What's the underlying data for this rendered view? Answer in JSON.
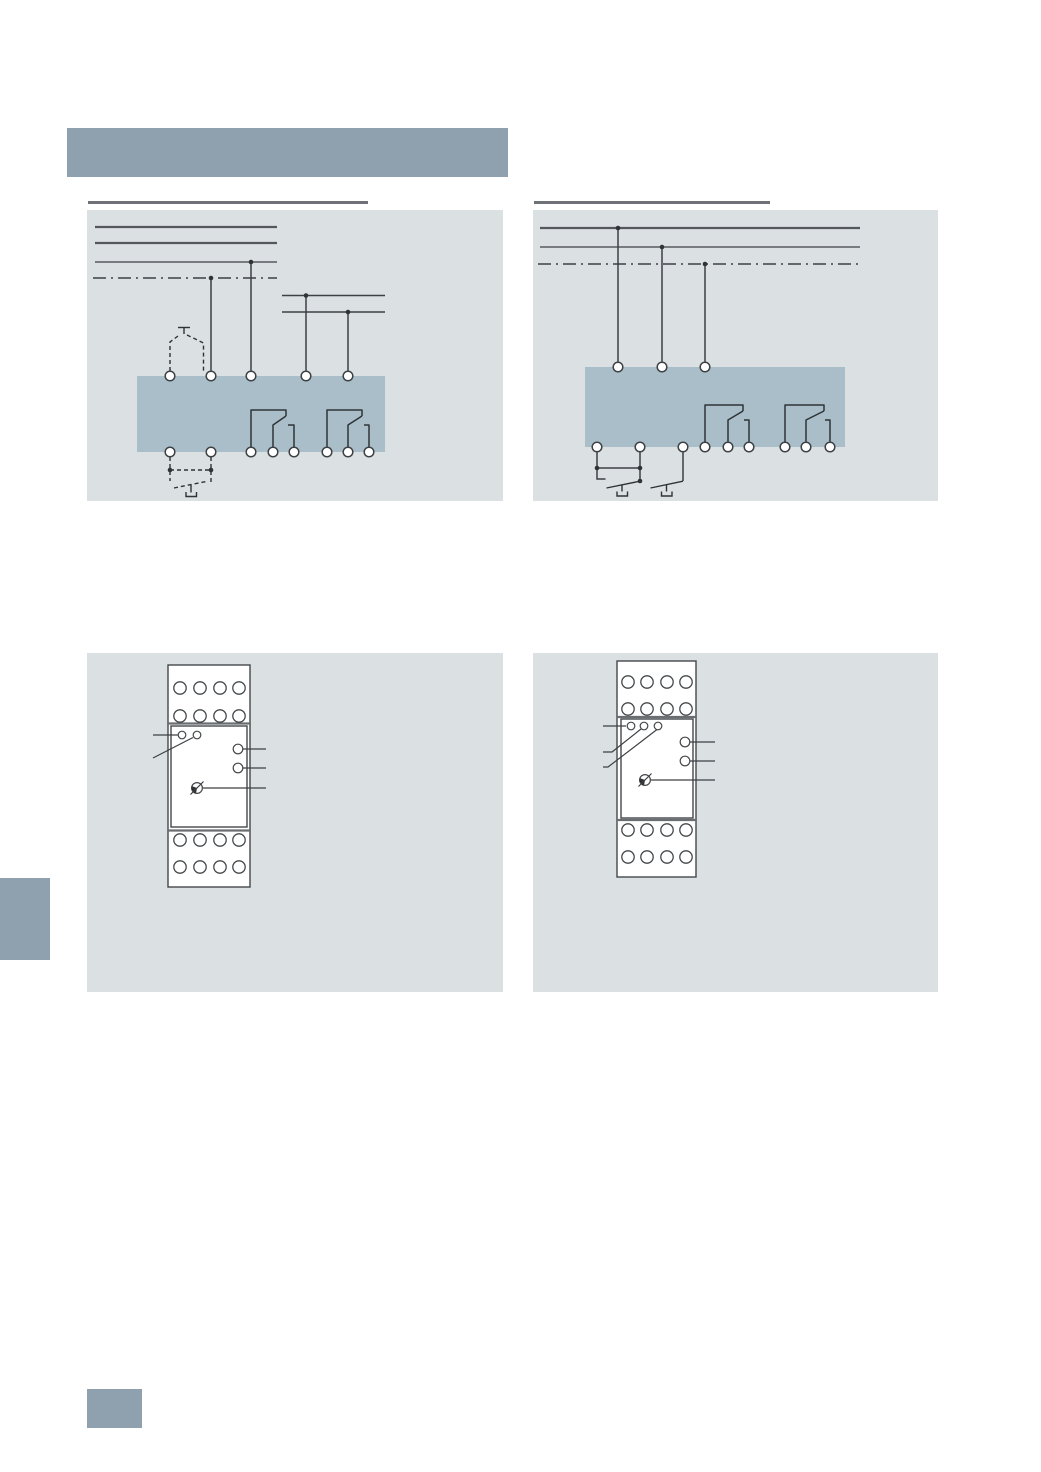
{
  "page": {
    "width": 1041,
    "height": 1472,
    "kind": "technical-catalog-page",
    "visible_text": ""
  },
  "colors": {
    "page_bg": "#ffffff",
    "accent": "#8fa1ae",
    "panel_bg": "#dbe0e3",
    "device_fill": "#a9bec9",
    "line": "#3d4144",
    "rail": "#54585c",
    "ink": "#2f3336",
    "rule": "#6e7276",
    "outline": "#44484b",
    "divider": "#6a6e72",
    "white": "#ffffff"
  },
  "header": {
    "caption_text": ""
  },
  "figures": [
    {
      "name": "wiring-diagram-left",
      "caption_text": "",
      "type": "schematic",
      "supply_rails_solid": 3,
      "supply_rails_dashdot": 1,
      "aux_rails": 2,
      "top_terminals": 5,
      "bottom_terminals": 8,
      "changeover_contacts": 2,
      "external_pushbuttons": 2,
      "pushbutton_wiring": "dashed"
    },
    {
      "name": "wiring-diagram-right",
      "caption_text": "",
      "type": "schematic",
      "supply_rails_solid": 2,
      "supply_rails_dashdot": 1,
      "aux_rails": 0,
      "top_terminals": 3,
      "bottom_terminals": 9,
      "changeover_contacts": 2,
      "external_pushbuttons": 2,
      "pushbutton_wiring": "solid"
    },
    {
      "name": "device-front-view-left",
      "caption_text": "",
      "type": "front-view",
      "terminal_rows_top": 2,
      "terminal_rows_bottom": 2,
      "terminals_per_row": 4,
      "indicator_leds": 2,
      "adjuster_dials": 2,
      "rotary_selector": 1,
      "callout_lines_left": 2,
      "callout_lines_right": 3
    },
    {
      "name": "device-front-view-right",
      "caption_text": "",
      "type": "front-view",
      "terminal_rows_top": 2,
      "terminal_rows_bottom": 2,
      "terminals_per_row": 4,
      "indicator_leds": 3,
      "adjuster_dials": 2,
      "rotary_selector": 1,
      "callout_lines_left": 3,
      "callout_lines_right": 3
    }
  ],
  "margin_marks": {
    "section_tab": "solid accent rectangle on left page edge",
    "page_number_block": "solid accent rectangle at bottom left"
  }
}
